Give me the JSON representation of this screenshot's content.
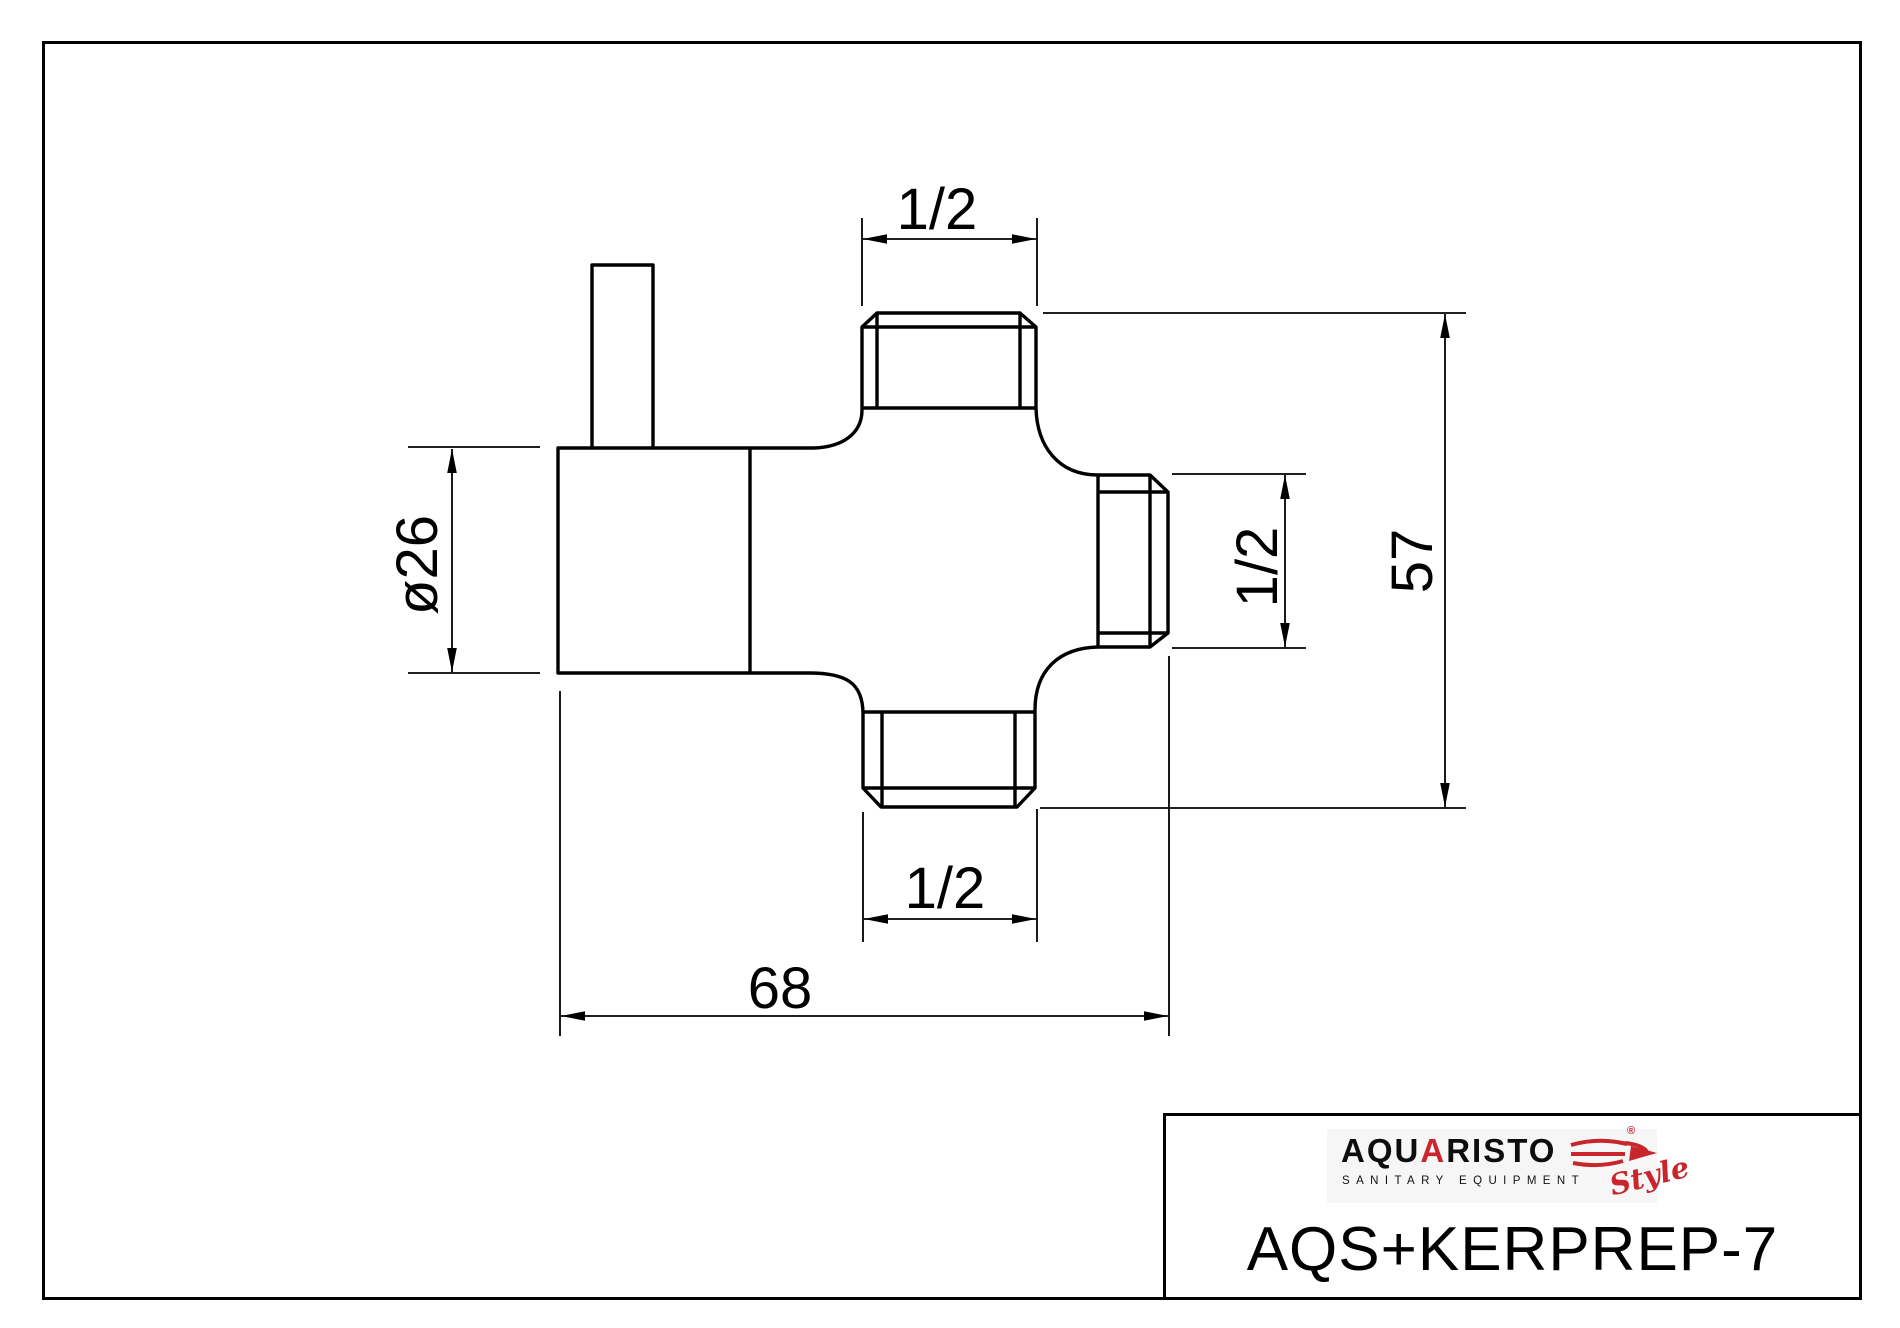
{
  "page": {
    "background_color": "#ffffff",
    "line_color": "#000000",
    "accent_color": "#c9252c"
  },
  "title_block": {
    "logo": {
      "brand_prefix": "AQU",
      "brand_accent": "A",
      "brand_suffix": "RISTO",
      "registered_mark": "®",
      "tagline": "SANITARY EQUIPMENT",
      "script_word": "Style"
    },
    "part_number": "AQS+KERPREP-7"
  },
  "drawing": {
    "type": "technical-drawing",
    "dimensions": {
      "top_thread": {
        "label": "1/2",
        "meaning": "top connector thread size"
      },
      "right_thread": {
        "label": "1/2",
        "meaning": "right connector thread size"
      },
      "bottom_thread": {
        "label": "1/2",
        "meaning": "bottom connector thread size"
      },
      "body_diameter": {
        "label": "ø26",
        "meaning": "body diameter"
      },
      "overall_height": {
        "label": "57",
        "meaning": "overall height"
      },
      "overall_width": {
        "label": "68",
        "meaning": "overall width"
      }
    }
  }
}
